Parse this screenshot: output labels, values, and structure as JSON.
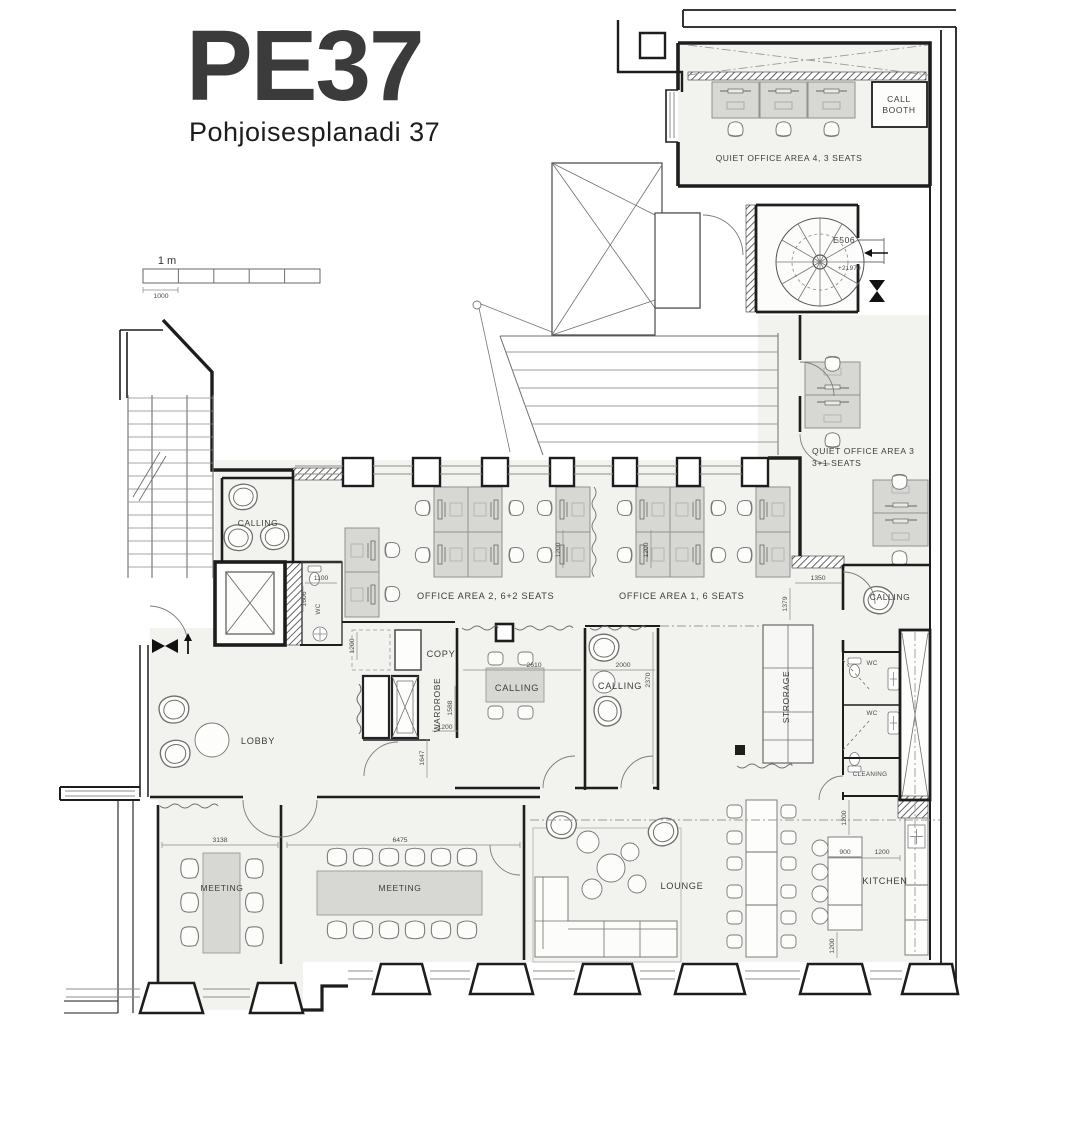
{
  "header": {
    "title": "PE37",
    "subtitle": "Pohjoisesplanadi 37",
    "title_color": "#8b7b3e"
  },
  "scale_bar": {
    "label": "1 m",
    "dim": "1000"
  },
  "stairwell": {
    "id": "E506",
    "level": "+21970"
  },
  "rooms": {
    "quiet_office_4": {
      "label": "QUIET OFFICE AREA 4, 3 SEATS"
    },
    "call_booth": {
      "line1": "CALL",
      "line2": "BOOTH"
    },
    "quiet_office_3": {
      "line1": "QUIET OFFICE AREA 3",
      "line2": "3+1 SEATS"
    },
    "office_area_2": {
      "label": "OFFICE AREA 2, 6+2 SEATS"
    },
    "office_area_1": {
      "label": "OFFICE AREA 1, 6 SEATS"
    },
    "calling_nw": {
      "label": "CALLING"
    },
    "wc_nw": {
      "label": "WC"
    },
    "copy": {
      "label": "COPY"
    },
    "wardrobe": {
      "label": "WARDROBE"
    },
    "calling_mid_table": {
      "label": "CALLING"
    },
    "calling_mid_lounge": {
      "label": "CALLING"
    },
    "storage": {
      "label": "STRORAGE"
    },
    "calling_e": {
      "label": "CALLING"
    },
    "wc_e1": {
      "label": "WC"
    },
    "wc_e2": {
      "label": "WC"
    },
    "cleaning": {
      "label": "CLEANING"
    },
    "lobby": {
      "label": "LOBBY"
    },
    "meeting_small": {
      "label": "MEETING"
    },
    "meeting_large": {
      "label": "MEETING"
    },
    "lounge": {
      "label": "LOUNGE"
    },
    "kitchen": {
      "label": "KITCHEN"
    }
  },
  "dimensions": {
    "wc_nw_w": "1100",
    "wc_nw_d": "1606",
    "copy_aisle": "1200",
    "wardrobe_d": "1588",
    "wardrobe_w": "1200",
    "lobby_clear": "1647",
    "calling_table_w": "2610",
    "calling_lounge_w": "2000",
    "calling_lounge_d": "2370",
    "pod_b": "1200",
    "pod_c": "1200",
    "office_end_w": "1350",
    "office_end_d": "1379",
    "meeting_small_w": "3138",
    "meeting_large_w": "6475",
    "kitchen_gap": "900",
    "kitchen_aisle": "1200",
    "kitchen_top": "1200",
    "kitchen_bottom": "1200"
  }
}
